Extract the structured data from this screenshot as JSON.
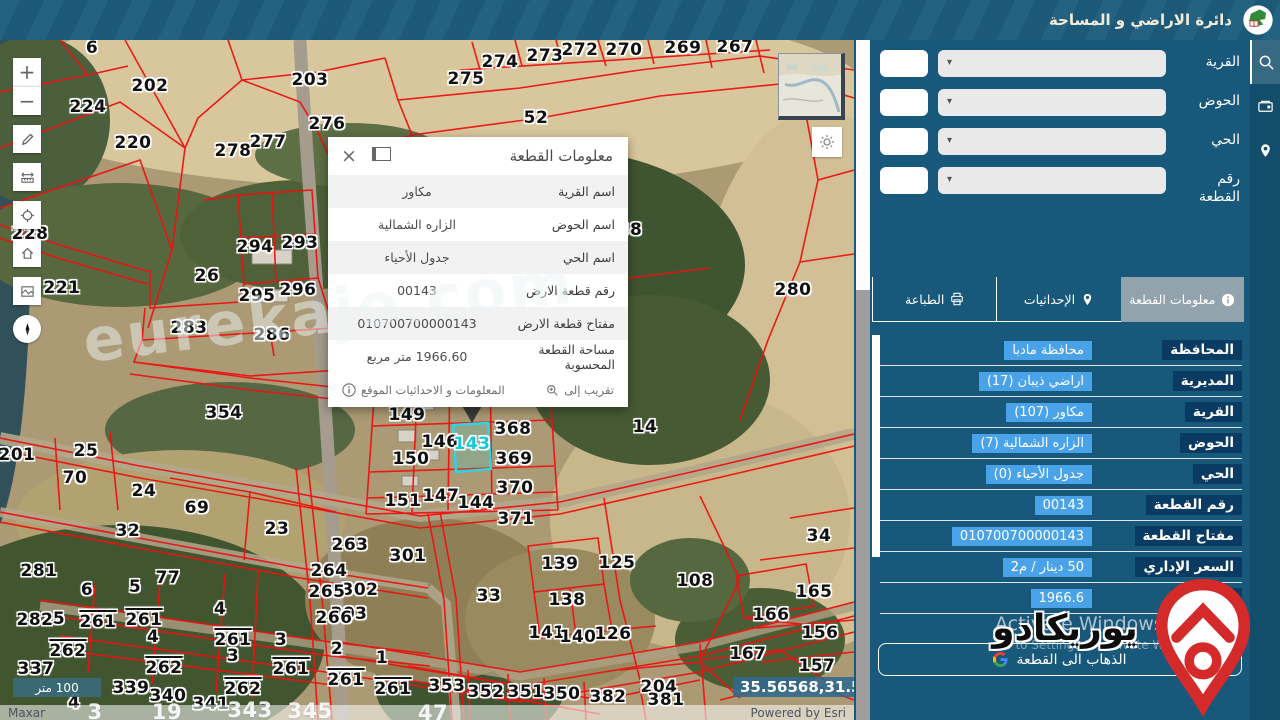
{
  "app": {
    "title": "دائرة الاراضي و المساحة"
  },
  "search_panel": {
    "rows": [
      {
        "key": "village",
        "label": "القرية"
      },
      {
        "key": "basin",
        "label": "الحوض"
      },
      {
        "key": "district",
        "label": "الحي"
      },
      {
        "key": "parcel-number",
        "label": "رقم القطعة"
      }
    ]
  },
  "tabs": [
    {
      "key": "parcel-info",
      "label": "معلومات القطعة",
      "icon": "info-icon",
      "active": true
    },
    {
      "key": "coordinates",
      "label": "الإحداثيات",
      "icon": "coordinates-icon",
      "active": false
    },
    {
      "key": "print",
      "label": "الطباعة",
      "icon": "printer-icon",
      "active": false
    }
  ],
  "details": {
    "rows": [
      {
        "label": "المحافظة",
        "value": "محافظة مادبا"
      },
      {
        "label": "المديرية",
        "value": "اراضي ذيبان (17)"
      },
      {
        "label": "القرية",
        "value": "مكاور (107)"
      },
      {
        "label": "الحوض",
        "value": "الزاره الشمالية (7)"
      },
      {
        "label": "الحي",
        "value": "جدول الأحياء (0)"
      },
      {
        "label": "رقم القطعة",
        "value": "00143"
      },
      {
        "label": "مفتاح القطعة",
        "value": "010700700000143"
      },
      {
        "label": "السعر الإداري",
        "value": "50 دينار / م2"
      },
      {
        "label": "المساحة",
        "value": "1966.6"
      }
    ],
    "activate_line1": "Activate Windows",
    "activate_line2": "Go to Settings to activate Windows.",
    "goto_button": "الذهاب الى القطعة"
  },
  "popup": {
    "title": "معلومات القطعة",
    "rows": [
      {
        "label": "اسم القرية",
        "value": "مكاور"
      },
      {
        "label": "اسم الحوض",
        "value": "الزاره الشمالية"
      },
      {
        "label": "اسم الحي",
        "value": "جدول الأحياء"
      },
      {
        "label": "رقم قطعة الارض",
        "value": "00143"
      },
      {
        "label": "مفتاح قطعة الارض",
        "value": "010700700000143"
      },
      {
        "label": "مساحة القطعة المحسوبة",
        "value": "1966.60 متر مربع"
      }
    ],
    "zoom_to": "تقريب إلى",
    "info_link": "المعلومات و الاحداثيات الموقع"
  },
  "map": {
    "selected_parcel": "143",
    "selected_parcel_pos": {
      "x": 472,
      "y": 404
    },
    "scale_bar": "100 متر",
    "coordinates": "35.56568,31.59776",
    "attribution_left": "Maxar",
    "attribution_right": "Powered by Esri",
    "watermark": "eurekajo.com",
    "toolbar": [
      {
        "name": "zoom-in"
      },
      {
        "name": "zoom-out"
      },
      {
        "name": "draw"
      },
      {
        "name": "measure"
      },
      {
        "name": "locate"
      },
      {
        "name": "home"
      },
      {
        "name": "basemap"
      },
      {
        "name": "compass"
      }
    ],
    "labels": [
      {
        "t": "6",
        "x": 92,
        "y": 8
      },
      {
        "t": "202",
        "x": 150,
        "y": 46
      },
      {
        "t": "224",
        "x": 88,
        "y": 67
      },
      {
        "t": "220",
        "x": 133,
        "y": 103
      },
      {
        "t": "203",
        "x": 310,
        "y": 40
      },
      {
        "t": "275",
        "x": 466,
        "y": 39
      },
      {
        "t": "274",
        "x": 500,
        "y": 22
      },
      {
        "t": "273",
        "x": 545,
        "y": 16
      },
      {
        "t": "272",
        "x": 580,
        "y": 10
      },
      {
        "t": "270",
        "x": 624,
        "y": 10
      },
      {
        "t": "269",
        "x": 683,
        "y": 8
      },
      {
        "t": "267",
        "x": 735,
        "y": 7
      },
      {
        "t": "276",
        "x": 327,
        "y": 84
      },
      {
        "t": "277",
        "x": 268,
        "y": 102
      },
      {
        "t": "278",
        "x": 233,
        "y": 111
      },
      {
        "t": "52",
        "x": 536,
        "y": 78
      },
      {
        "t": "38",
        "x": 630,
        "y": 190
      },
      {
        "t": "228",
        "x": 30,
        "y": 194
      },
      {
        "t": "294",
        "x": 255,
        "y": 207
      },
      {
        "t": "293",
        "x": 300,
        "y": 203
      },
      {
        "t": "26",
        "x": 207,
        "y": 236
      },
      {
        "t": "295",
        "x": 257,
        "y": 256
      },
      {
        "t": "296",
        "x": 298,
        "y": 250
      },
      {
        "t": "221",
        "x": 62,
        "y": 248
      },
      {
        "t": "283",
        "x": 189,
        "y": 288
      },
      {
        "t": "286",
        "x": 272,
        "y": 295
      },
      {
        "t": "280",
        "x": 793,
        "y": 250
      },
      {
        "t": "354",
        "x": 224,
        "y": 373
      },
      {
        "t": "149",
        "x": 407,
        "y": 375
      },
      {
        "t": "146",
        "x": 440,
        "y": 402
      },
      {
        "t": "368",
        "x": 513,
        "y": 389
      },
      {
        "t": "150",
        "x": 411,
        "y": 419
      },
      {
        "t": "369",
        "x": 514,
        "y": 419
      },
      {
        "t": "370",
        "x": 515,
        "y": 448
      },
      {
        "t": "147",
        "x": 441,
        "y": 456
      },
      {
        "t": "144",
        "x": 476,
        "y": 463
      },
      {
        "t": "151",
        "x": 403,
        "y": 461
      },
      {
        "t": "371",
        "x": 516,
        "y": 479
      },
      {
        "t": "14",
        "x": 645,
        "y": 387
      },
      {
        "t": "201",
        "x": 17,
        "y": 415
      },
      {
        "t": "25",
        "x": 86,
        "y": 411
      },
      {
        "t": "70",
        "x": 75,
        "y": 438
      },
      {
        "t": "24",
        "x": 144,
        "y": 451
      },
      {
        "t": "69",
        "x": 197,
        "y": 468
      },
      {
        "t": "32",
        "x": 128,
        "y": 491
      },
      {
        "t": "23",
        "x": 277,
        "y": 489
      },
      {
        "t": "34",
        "x": 819,
        "y": 496
      },
      {
        "t": "263",
        "x": 350,
        "y": 505
      },
      {
        "t": "301",
        "x": 408,
        "y": 516
      },
      {
        "t": "264",
        "x": 329,
        "y": 531
      },
      {
        "t": "302",
        "x": 360,
        "y": 550
      },
      {
        "t": "265",
        "x": 327,
        "y": 552
      },
      {
        "t": "303",
        "x": 349,
        "y": 574
      },
      {
        "t": "266",
        "x": 334,
        "y": 578
      },
      {
        "t": "33",
        "x": 489,
        "y": 556
      },
      {
        "t": "125",
        "x": 617,
        "y": 523
      },
      {
        "t": "139",
        "x": 560,
        "y": 524
      },
      {
        "t": "138",
        "x": 567,
        "y": 560
      },
      {
        "t": "108",
        "x": 695,
        "y": 541
      },
      {
        "t": "141",
        "x": 547,
        "y": 593
      },
      {
        "t": "140",
        "x": 578,
        "y": 597
      },
      {
        "t": "126",
        "x": 613,
        "y": 594
      },
      {
        "t": "165",
        "x": 814,
        "y": 552
      },
      {
        "t": "166",
        "x": 771,
        "y": 575
      },
      {
        "t": "156",
        "x": 820,
        "y": 593
      },
      {
        "t": "167",
        "x": 748,
        "y": 614
      },
      {
        "t": "157",
        "x": 817,
        "y": 626
      },
      {
        "t": "204",
        "x": 659,
        "y": 647
      },
      {
        "t": "281",
        "x": 39,
        "y": 531
      },
      {
        "t": "6",
        "x": 87,
        "y": 550
      },
      {
        "t": "5",
        "x": 135,
        "y": 547
      },
      {
        "t": "77",
        "x": 168,
        "y": 538
      },
      {
        "t": "4",
        "x": 220,
        "y": 569
      },
      {
        "t": "282",
        "x": 35,
        "y": 580
      },
      {
        "t": "5",
        "x": 59,
        "y": 579
      },
      {
        "t": "4",
        "x": 153,
        "y": 597
      },
      {
        "t": "2",
        "x": 337,
        "y": 609
      },
      {
        "t": "1",
        "x": 382,
        "y": 618
      },
      {
        "t": "3",
        "x": 233,
        "y": 616
      },
      {
        "t": "3",
        "x": 281,
        "y": 600
      },
      {
        "t": "337",
        "x": 36,
        "y": 629
      },
      {
        "t": "339",
        "x": 131,
        "y": 648
      },
      {
        "t": "340",
        "x": 168,
        "y": 656
      },
      {
        "t": "341",
        "x": 211,
        "y": 664
      },
      {
        "t": "353",
        "x": 447,
        "y": 646
      },
      {
        "t": "352",
        "x": 486,
        "y": 652
      },
      {
        "t": "351",
        "x": 526,
        "y": 652
      },
      {
        "t": "350",
        "x": 562,
        "y": 654
      },
      {
        "t": "382",
        "x": 608,
        "y": 657
      },
      {
        "t": "381",
        "x": 666,
        "y": 660
      },
      {
        "t": "4",
        "x": 74,
        "y": 663
      }
    ],
    "overline_labels": [
      {
        "t": "261",
        "x": 98,
        "y": 582
      },
      {
        "t": "261",
        "x": 144,
        "y": 580
      },
      {
        "t": "262",
        "x": 68,
        "y": 611
      },
      {
        "t": "262",
        "x": 164,
        "y": 628
      },
      {
        "t": "261",
        "x": 233,
        "y": 600
      },
      {
        "t": "262",
        "x": 243,
        "y": 649
      },
      {
        "t": "261",
        "x": 291,
        "y": 629
      },
      {
        "t": "261",
        "x": 346,
        "y": 640
      },
      {
        "t": "261",
        "x": 393,
        "y": 649
      }
    ],
    "white_labels": [
      {
        "t": "3",
        "x": 95,
        "y": 672
      },
      {
        "t": "19",
        "x": 167,
        "y": 672
      },
      {
        "t": "343",
        "x": 250,
        "y": 670
      },
      {
        "t": "345",
        "x": 310,
        "y": 671
      },
      {
        "t": "47",
        "x": 433,
        "y": 673
      }
    ]
  },
  "sidebar_icons": [
    {
      "name": "search",
      "active": true
    },
    {
      "name": "layers-card",
      "active": false
    },
    {
      "name": "location-pin",
      "active": false
    }
  ],
  "brand": {
    "text": "يوريكادو"
  },
  "colors": {
    "parcel_line": "#ee1111",
    "selection": "#2fd4e3",
    "panel": "#17587b",
    "label_chip": "#0a3c63",
    "value_chip": "#4aa3e8",
    "topbar": "#1d5d7d"
  }
}
